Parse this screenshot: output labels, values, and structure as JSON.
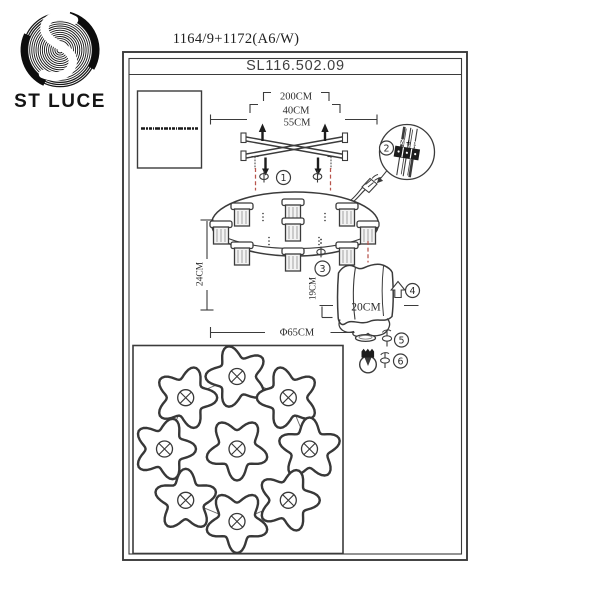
{
  "brand": {
    "name": "ST LUCE",
    "logo": "st-luce-spiral-s"
  },
  "header": {
    "model": "1164/9+1172(A6/W)",
    "sku": "SL116.502.09"
  },
  "dimensions": {
    "suspension": "200CM",
    "rod": "40CM",
    "bracket": "55CM",
    "fixture_height": "24CM",
    "base_diameter": "Φ65CM",
    "shade_height": "19CM",
    "shade_width": "20CM"
  },
  "steps": [
    "1",
    "2",
    "3",
    "4",
    "5",
    "6"
  ],
  "wiring": {
    "neutral": "N",
    "live": "L",
    "ground_icon": "earth-ground"
  },
  "colors": {
    "ink": "#3b3b3b",
    "guide_red": "#b8544c",
    "paper": "#ffffff"
  }
}
